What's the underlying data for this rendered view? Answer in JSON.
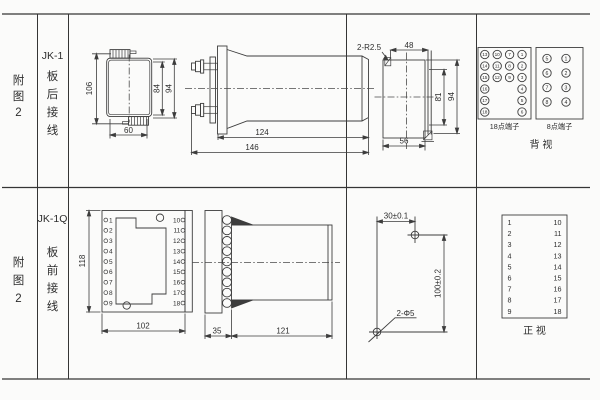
{
  "sheet": {
    "bg": "#fbfbfa",
    "ink": "#3d3d3d"
  },
  "sidebar_top": {
    "fig": [
      "附",
      "图",
      "2"
    ],
    "model": "JK-1",
    "mode": [
      "板",
      "后",
      "接",
      "线"
    ]
  },
  "sidebar_bottom": {
    "fig": [
      "附",
      "图",
      "2"
    ],
    "model": "JK-1Q",
    "mode": [
      "板",
      "前",
      "接",
      "线"
    ]
  },
  "jk1_front": {
    "dim_overall_h": "106",
    "dim_inner_h": "84",
    "dim_outer_h": "94",
    "dim_w": "60"
  },
  "jk1_side": {
    "dim_body": "124",
    "dim_overall": "146"
  },
  "jk1_cutout": {
    "radius_note": "2-R2.5",
    "dim_top": "48",
    "dim_inner_h": "81",
    "dim_outer_h": "94",
    "dim_bottom": "56"
  },
  "jk1_back": {
    "label_18": "18点端子",
    "label_8": "8点端子",
    "view_label": "背 视",
    "t18": [
      "13",
      "10",
      "7",
      "1",
      "14",
      "11",
      "8",
      "2",
      "15",
      "12",
      "9",
      "3",
      "16",
      "4",
      "17",
      "5",
      "18",
      "6"
    ],
    "t8": [
      "5",
      "1",
      "6",
      "2",
      "7",
      "3",
      "8",
      "4"
    ]
  },
  "jk1q_front": {
    "dim_h": "118",
    "dim_w": "102",
    "left": [
      "1",
      "2",
      "3",
      "4",
      "5",
      "6",
      "7",
      "8",
      "9"
    ],
    "right": [
      "10",
      "11",
      "12",
      "13",
      "14",
      "15",
      "16",
      "17",
      "18"
    ]
  },
  "jk1q_side": {
    "dim_front": "35",
    "dim_body": "121"
  },
  "jk1q_drill": {
    "dim_x": "30±0.1",
    "dim_y": "100±0.2",
    "hole_note": "2-Φ5"
  },
  "jk1q_view": {
    "left": [
      "1",
      "2",
      "3",
      "4",
      "5",
      "6",
      "7",
      "8",
      "9"
    ],
    "right": [
      "10",
      "11",
      "12",
      "13",
      "14",
      "15",
      "16",
      "17",
      "18"
    ],
    "view_label": "正 视"
  }
}
